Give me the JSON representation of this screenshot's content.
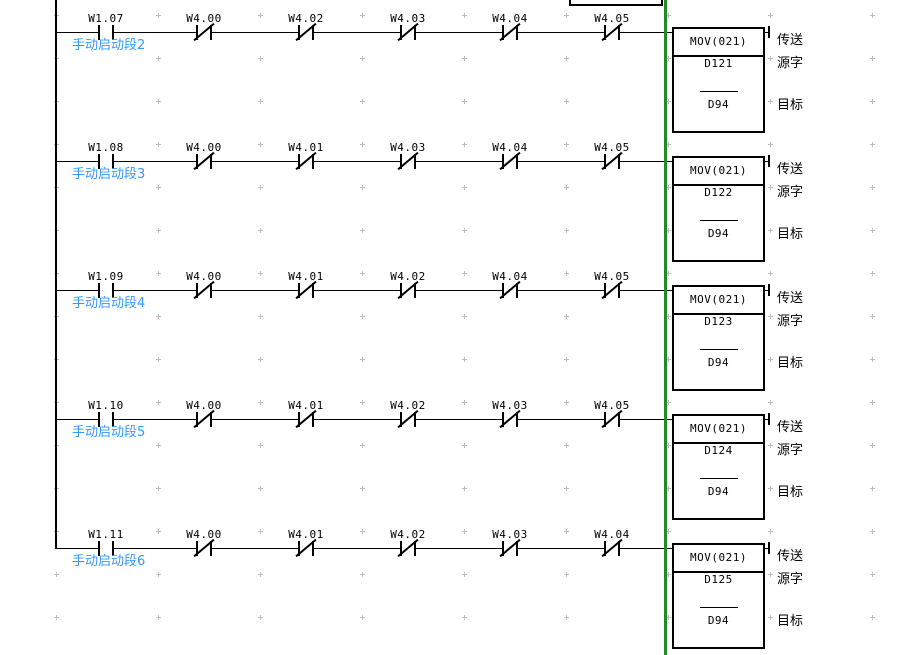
{
  "editor": {
    "background_color": "#ffffff",
    "section_divider_color": "#228B22",
    "comment_color": "#3399ff",
    "grid_dot_color": "#bdbdbd"
  },
  "block_annotations": {
    "title": "传送",
    "source": "源字",
    "dest": "目标"
  },
  "rungs": [
    {
      "comment": "手动启动段2",
      "input_contact": {
        "label": "W1.07",
        "type": "normally-open"
      },
      "interlock_contacts": [
        {
          "label": "W4.00"
        },
        {
          "label": "W4.02"
        },
        {
          "label": "W4.03"
        },
        {
          "label": "W4.04"
        },
        {
          "label": "W4.05"
        }
      ],
      "instruction": {
        "mnemonic": "MOV(021)",
        "source": "D121",
        "dest": "D94"
      }
    },
    {
      "comment": "手动启动段3",
      "input_contact": {
        "label": "W1.08",
        "type": "normally-open"
      },
      "interlock_contacts": [
        {
          "label": "W4.00"
        },
        {
          "label": "W4.01"
        },
        {
          "label": "W4.03"
        },
        {
          "label": "W4.04"
        },
        {
          "label": "W4.05"
        }
      ],
      "instruction": {
        "mnemonic": "MOV(021)",
        "source": "D122",
        "dest": "D94"
      }
    },
    {
      "comment": "手动启动段4",
      "input_contact": {
        "label": "W1.09",
        "type": "normally-open"
      },
      "interlock_contacts": [
        {
          "label": "W4.00"
        },
        {
          "label": "W4.01"
        },
        {
          "label": "W4.02"
        },
        {
          "label": "W4.04"
        },
        {
          "label": "W4.05"
        }
      ],
      "instruction": {
        "mnemonic": "MOV(021)",
        "source": "D123",
        "dest": "D94"
      }
    },
    {
      "comment": "手动启动段5",
      "input_contact": {
        "label": "W1.10",
        "type": "normally-open"
      },
      "interlock_contacts": [
        {
          "label": "W4.00"
        },
        {
          "label": "W4.01"
        },
        {
          "label": "W4.02"
        },
        {
          "label": "W4.03"
        },
        {
          "label": "W4.05"
        }
      ],
      "instruction": {
        "mnemonic": "MOV(021)",
        "source": "D124",
        "dest": "D94"
      }
    },
    {
      "comment": "手动启动段6",
      "input_contact": {
        "label": "W1.11",
        "type": "normally-open"
      },
      "interlock_contacts": [
        {
          "label": "W4.00"
        },
        {
          "label": "W4.01"
        },
        {
          "label": "W4.02"
        },
        {
          "label": "W4.03"
        },
        {
          "label": "W4.04"
        }
      ],
      "instruction": {
        "mnemonic": "MOV(021)",
        "source": "D125",
        "dest": "D94"
      }
    }
  ]
}
